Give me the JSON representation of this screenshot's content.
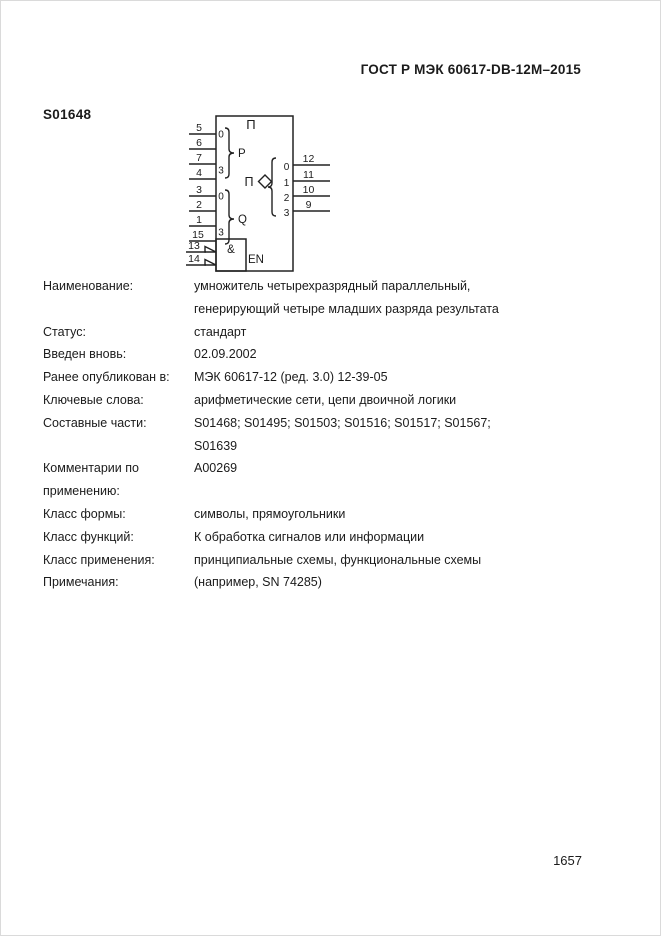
{
  "header": {
    "standard": "ГОСТ Р МЭК 60617-DB-12M–2015"
  },
  "symbol": {
    "id": "S01648"
  },
  "footer": {
    "page_number": "1657"
  },
  "diagram": {
    "function_label": "Π",
    "output_function_label": "Π",
    "p_group": {
      "name": "P",
      "first_bit": "0",
      "last_bit": "3",
      "pins": [
        "5",
        "6",
        "7",
        "4"
      ]
    },
    "q_group": {
      "name": "Q",
      "first_bit": "0",
      "last_bit": "3",
      "pins": [
        "3",
        "2",
        "1",
        "15"
      ]
    },
    "en": {
      "gate_label": "&",
      "label": "EN",
      "pins": [
        "13",
        "14"
      ]
    },
    "outputs": {
      "bits": [
        "0",
        "1",
        "2",
        "3"
      ],
      "pins": [
        "12",
        "11",
        "10",
        "9"
      ]
    }
  },
  "properties": {
    "rows": [
      {
        "label": "Наименование:",
        "value": "умножитель четырехразрядный параллельный,\nгенерирующий четыре младших разряда результата"
      },
      {
        "label": "Статус:",
        "value": "стандарт"
      },
      {
        "label": "Введен вновь:",
        "value": "02.09.2002"
      },
      {
        "label": "Ранее опубликован в:",
        "value": "МЭК 60617-12 (ред. 3.0) 12-39-05"
      },
      {
        "label": "Ключевые слова:",
        "value": "арифметические сети, цепи двоичной логики"
      },
      {
        "label": "Составные части:",
        "value": "S01468; S01495; S01503; S01516; S01517; S01567;\nS01639"
      },
      {
        "label": "Комментарии по\nприменению:",
        "value": "A00269"
      },
      {
        "label": "Класс формы:",
        "value": "символы, прямоугольники"
      },
      {
        "label": "Класс функций:",
        "value": "К обработка сигналов или информации"
      },
      {
        "label": "Класс применения:",
        "value": "принципиальные схемы, функциональные схемы"
      },
      {
        "label": "Примечания:",
        "value": "(например, SN 74285)"
      }
    ]
  }
}
